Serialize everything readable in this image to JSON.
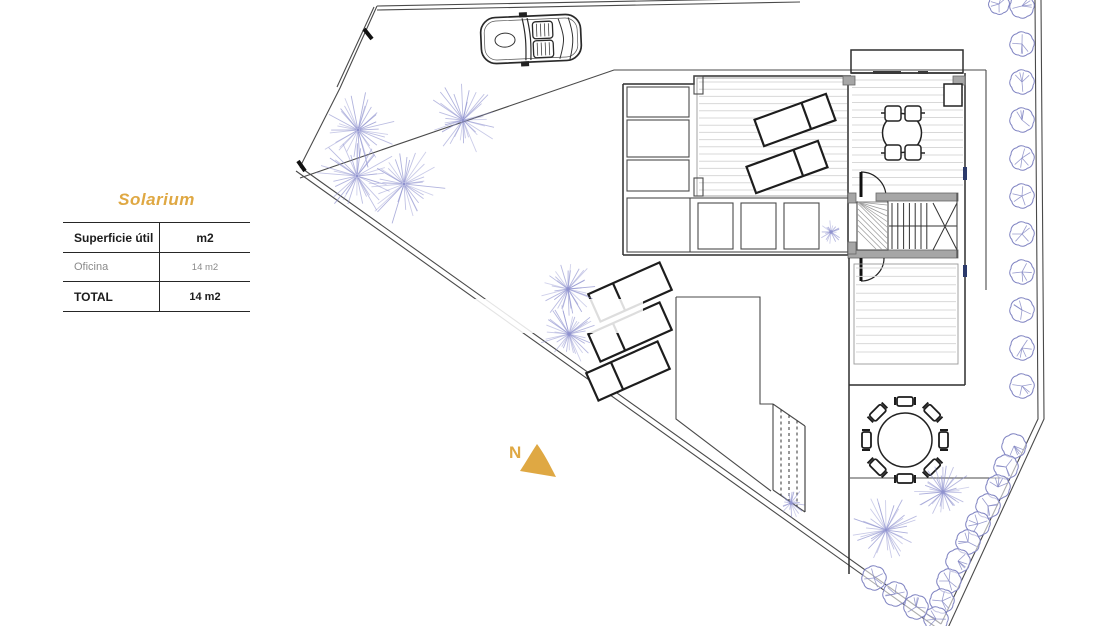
{
  "legend": {
    "title": "Solarium",
    "table": {
      "headers": [
        "Superficie útil",
        "m2"
      ],
      "rows": [
        {
          "label": "Oficina",
          "value": "14 m2"
        }
      ],
      "total": {
        "label": "TOTAL",
        "value": "14 m2"
      }
    }
  },
  "compass": {
    "label": "N"
  },
  "colors": {
    "accent": "#dfa843",
    "plant": "#8f92cf",
    "hedge": "#8084c2",
    "wall": "#a6a6a6",
    "deck_line": "#d8d8d8",
    "window_mark": "#2c3a6b"
  }
}
